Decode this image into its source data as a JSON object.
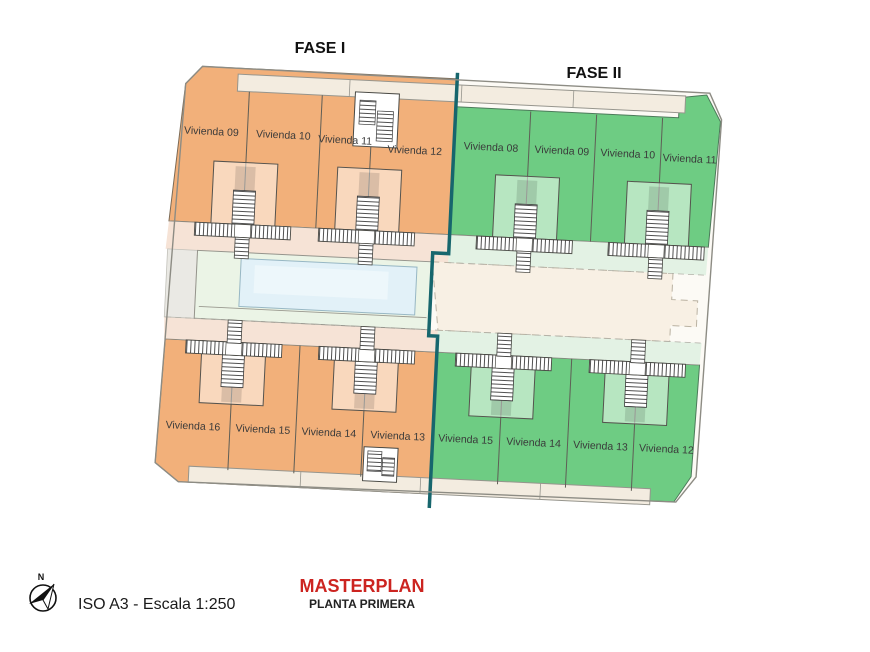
{
  "phases": {
    "fase1_label": "FASE I",
    "fase2_label": "FASE II"
  },
  "units": {
    "top_fase1": [
      {
        "label": "Vivienda 09"
      },
      {
        "label": "Vivienda 10"
      },
      {
        "label": "Vivienda 11"
      },
      {
        "label": "Vivienda 12"
      }
    ],
    "top_fase2": [
      {
        "label": "Vivienda 08"
      },
      {
        "label": "Vivienda 09"
      },
      {
        "label": "Vivienda 10"
      },
      {
        "label": "Vivienda 11"
      }
    ],
    "bottom_fase1": [
      {
        "label": "Vivienda 16"
      },
      {
        "label": "Vivienda 15"
      },
      {
        "label": "Vivienda 14"
      },
      {
        "label": "Vivienda 13"
      }
    ],
    "bottom_fase2": [
      {
        "label": "Vivienda 15"
      },
      {
        "label": "Vivienda 14"
      },
      {
        "label": "Vivienda 13"
      },
      {
        "label": "Vivienda 12"
      }
    ]
  },
  "footer": {
    "north_label": "N",
    "scale_text": "ISO A3 - Escala 1:250",
    "title": "MASTERPLAN",
    "subtitle": "PLANTA PRIMERA"
  },
  "colors": {
    "fase1_fill": "#f2b07a",
    "fase2_fill": "#6ecc83",
    "fase1_light": "#f6e3d6",
    "fase2_light": "#e3f2e4",
    "divider": "#17666d",
    "pool_water": "#e2f1f8",
    "pool_deck": "#ebf4e6",
    "open_area": "#f8f0e4",
    "sidewalk": "#f3ece0",
    "title_color": "#cc2420"
  }
}
